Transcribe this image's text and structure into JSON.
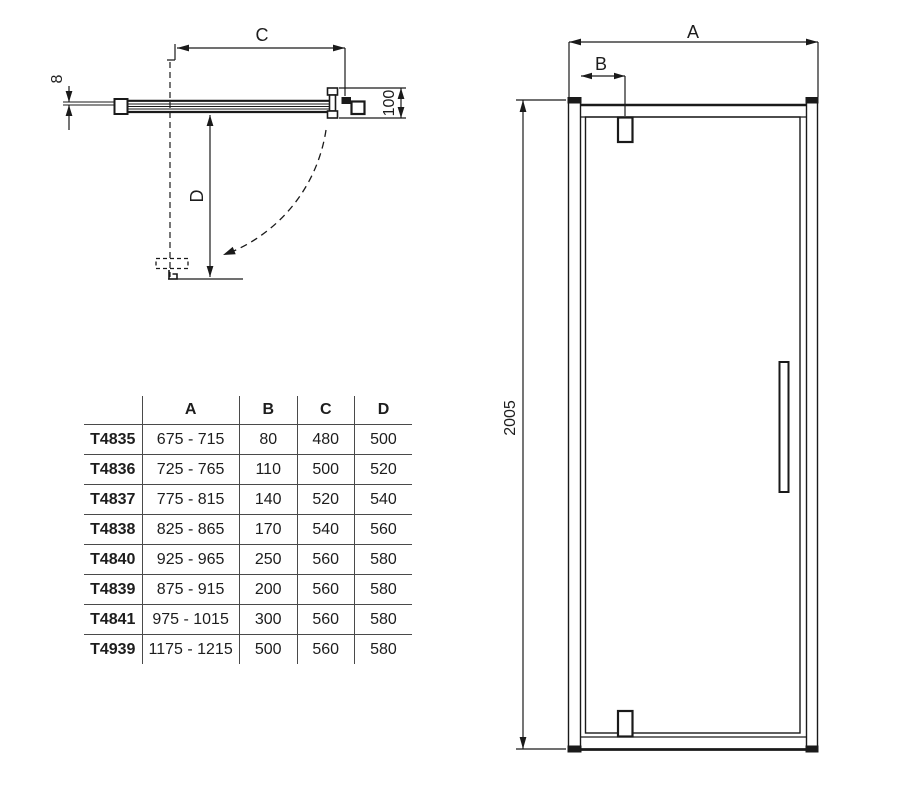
{
  "colors": {
    "line": "#1a1a1a",
    "table_line": "#4a4a4a",
    "background": "#ffffff"
  },
  "plan_view": {
    "glass_thickness": "8",
    "door_width_label": "C",
    "swing_depth_label": "D",
    "profile_depth": "100"
  },
  "front_view": {
    "overall_width_label": "A",
    "hinge_offset_label": "B",
    "height": "2005"
  },
  "table": {
    "headers": [
      "",
      "A",
      "B",
      "C",
      "D"
    ],
    "rows": [
      {
        "model": "T4835",
        "a": "675 - 715",
        "b": "80",
        "c": "480",
        "d": "500"
      },
      {
        "model": "T4836",
        "a": "725 - 765",
        "b": "110",
        "c": "500",
        "d": "520"
      },
      {
        "model": "T4837",
        "a": "775 - 815",
        "b": "140",
        "c": "520",
        "d": "540"
      },
      {
        "model": "T4838",
        "a": "825 - 865",
        "b": "170",
        "c": "540",
        "d": "560"
      },
      {
        "model": "T4840",
        "a": "925 - 965",
        "b": "250",
        "c": "560",
        "d": "580"
      },
      {
        "model": "T4839",
        "a": "875 - 915",
        "b": "200",
        "c": "560",
        "d": "580"
      },
      {
        "model": "T4841",
        "a": "975 - 1015",
        "b": "300",
        "c": "560",
        "d": "580"
      },
      {
        "model": "T4939",
        "a": "1175 - 1215",
        "b": "500",
        "c": "560",
        "d": "580"
      }
    ]
  }
}
